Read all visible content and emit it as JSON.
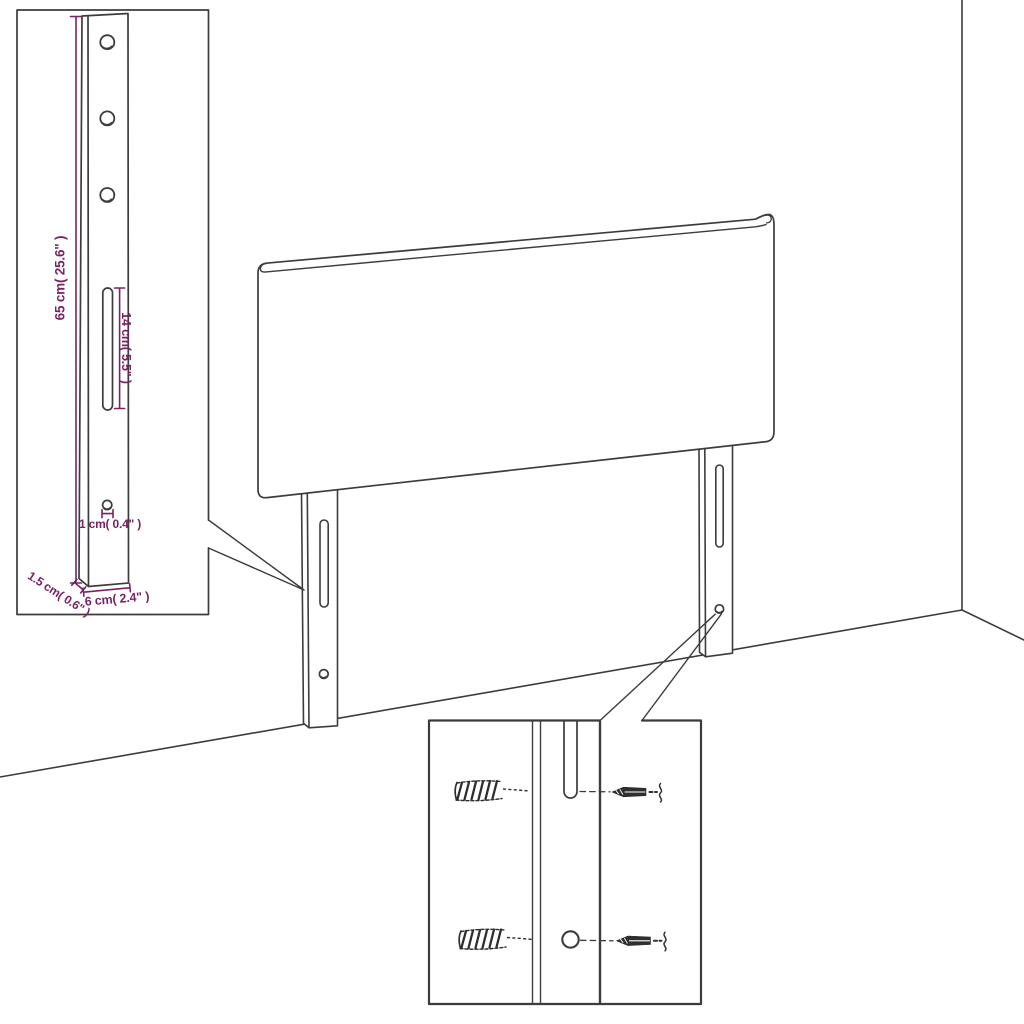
{
  "diagram": {
    "type": "headboard-assembly-dimension-diagram",
    "background_color": "#ffffff",
    "line_color": "#3c3c3c",
    "dimension_color": "#7a2364"
  },
  "dimensions": {
    "post_height": "65 cm( 25.6\" )",
    "slot_length": "14 cm( 5.5\" )",
    "hole_diameter": "1 cm( 0.4\" )",
    "post_width": "6 cm( 2.4\" )",
    "post_depth": "1.5 cm( 0.6\" )"
  }
}
